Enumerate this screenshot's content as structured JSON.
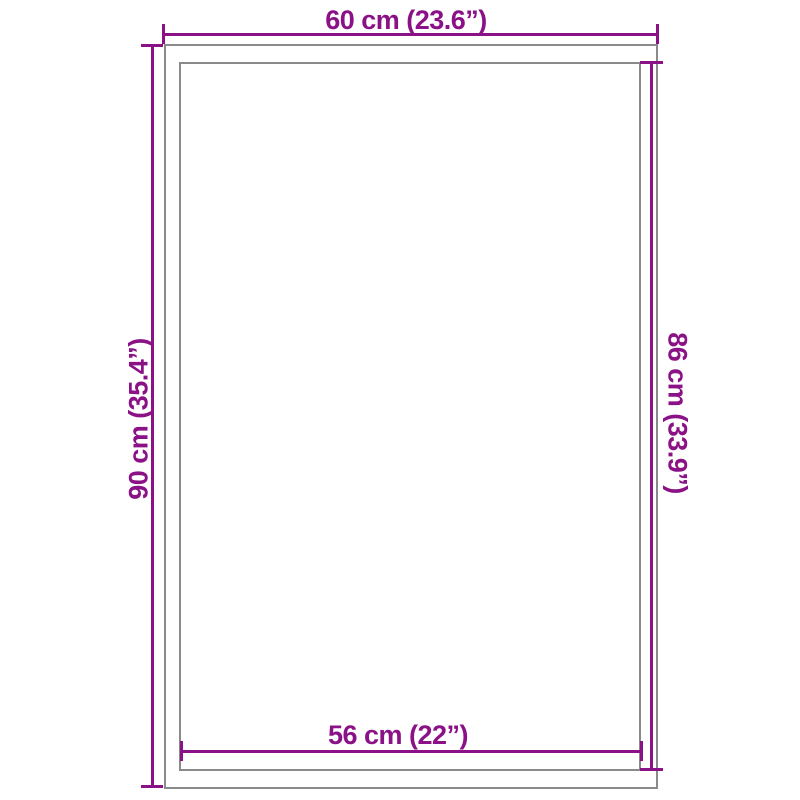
{
  "diagram": {
    "kind": "product-dimension-diagram",
    "colors": {
      "dimension_line": "#8A1186",
      "outline": "#8A8A8A",
      "background": "#FFFFFF"
    },
    "dimensions": {
      "top": {
        "label": "60 cm (23.6”)"
      },
      "left": {
        "label": "90 cm (35.4”)"
      },
      "right": {
        "label": "86 cm (33.9”)"
      },
      "bottom": {
        "label": "56 cm (22”)"
      }
    }
  }
}
